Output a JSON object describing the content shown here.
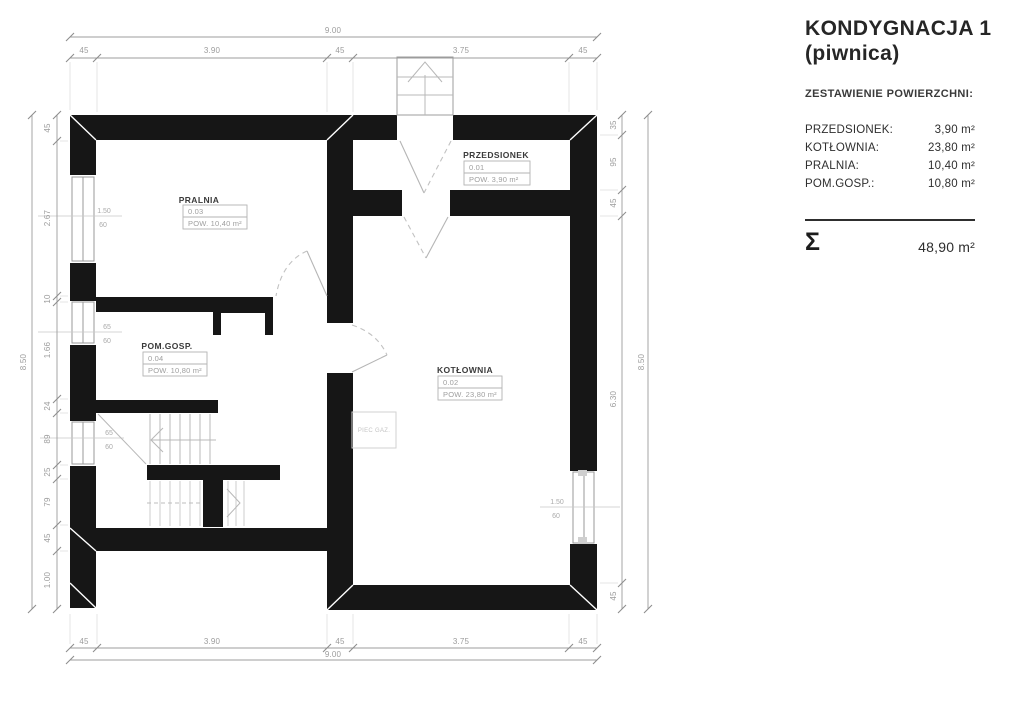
{
  "panel": {
    "title_line1": "KONDYGNACJA 1",
    "title_line2": "(piwnica)",
    "subtitle": "ZESTAWIENIE POWIERZCHNI:",
    "rooms": [
      {
        "label": "PRZEDSIONEK:",
        "area": "3,90 m²"
      },
      {
        "label": "KOTŁOWNIA:",
        "area": "23,80 m²"
      },
      {
        "label": "PRALNIA:",
        "area": "10,40 m²"
      },
      {
        "label": "POM.GOSP.:",
        "area": "10,80 m²"
      }
    ],
    "sum_symbol": "Σ",
    "total": "48,90 m²"
  },
  "plan": {
    "rooms": [
      {
        "name": "PRALNIA",
        "number": "0.03",
        "area": "POW. 10,40 m²"
      },
      {
        "name": "PRZEDSIONEK",
        "number": "0.01",
        "area": "POW. 3,90 m²"
      },
      {
        "name": "POM.GOSP.",
        "number": "0.04",
        "area": "POW. 10,80 m²"
      },
      {
        "name": "KOTŁOWNIA",
        "number": "0.02",
        "area": "POW. 23,80 m²"
      }
    ],
    "equipment_label": "PIEC GAZ.",
    "window_labels": [
      {
        "w": "1.50",
        "h": "60"
      },
      {
        "w": "65",
        "h": "60"
      },
      {
        "w": "65",
        "h": "60"
      },
      {
        "w": "1.50",
        "h": "60"
      }
    ]
  },
  "dimensions": {
    "top_total": "9.00",
    "top": [
      "45",
      "3.90",
      "45",
      "3.75",
      "45"
    ],
    "bottom": [
      "45",
      "3.90",
      "45",
      "3.75",
      "45"
    ],
    "bottom_total": "9.00",
    "left_total": "8.50",
    "left": [
      "45",
      "2.67",
      "10",
      "1.66",
      "24",
      "89",
      "25",
      "79",
      "45",
      "1.00"
    ],
    "right": [
      "35",
      "95",
      "45",
      "6.30",
      "45"
    ],
    "right_total": "8.50"
  }
}
